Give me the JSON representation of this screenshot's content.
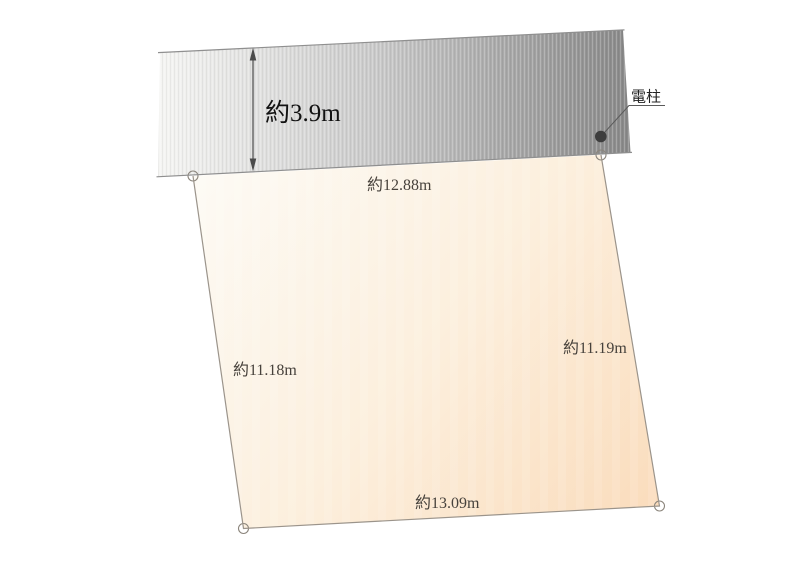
{
  "road": {
    "width_label": "約3.9m",
    "colors": {
      "left": "#f5f5f3",
      "mid": "#cbcbcb",
      "right": "#898989",
      "edge_line": "#8f8f8f"
    }
  },
  "pole": {
    "label": "電柱",
    "marker_fill": "#3e3e3e",
    "leader_color": "#5a5a5a"
  },
  "plot": {
    "labels": {
      "top": "約12.88m",
      "left": "約11.18m",
      "right": "約11.19m",
      "bottom": "約13.09m"
    },
    "colors": {
      "light": "#fdfaf4",
      "mid": "#fcefdd",
      "dark": "#fadcbc",
      "edge_line": "#9b948b",
      "corner_stroke": "#8b857c"
    }
  },
  "dimension": {
    "arrow_color": "#4a4a4a",
    "label_color": "#47423c",
    "road_label_color": "#121212",
    "pole_label_color": "#222222"
  }
}
